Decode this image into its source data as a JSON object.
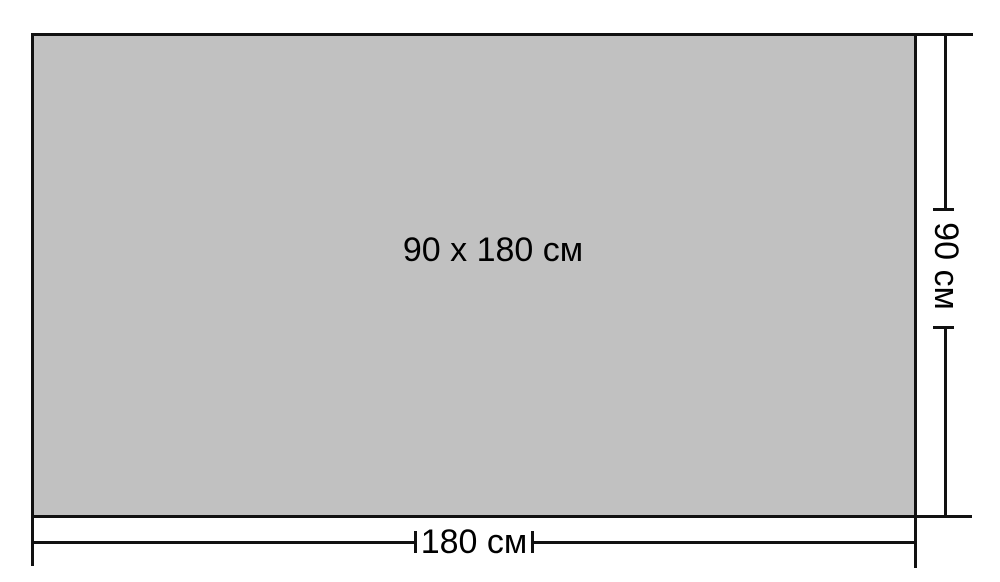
{
  "diagram": {
    "center_label": "90 x 180 см",
    "width_dimension": {
      "label": "180 см"
    },
    "height_dimension": {
      "label": "90 см"
    },
    "colors": {
      "background": "#ffffff",
      "surface": "#c1c1c1",
      "line": "#111111",
      "text": "#000000"
    }
  }
}
